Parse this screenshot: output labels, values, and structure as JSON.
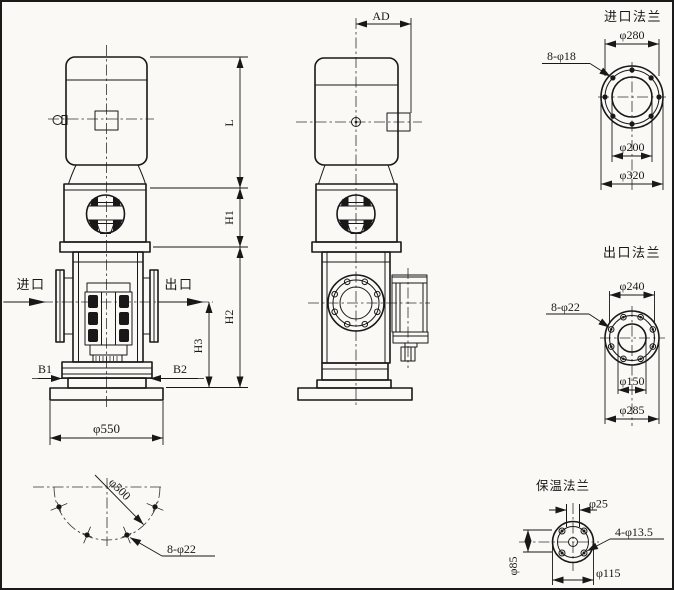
{
  "sheet": {
    "background": "#faf9f6",
    "line_color": "#181818"
  },
  "front_view": {
    "inlet_label": "进口",
    "outlet_label": "出口",
    "b1": "B1",
    "b2": "B2",
    "base_dia": "φ550",
    "dim_l": "L",
    "dim_h1": "H1",
    "dim_h2": "H2",
    "dim_h3": "H3"
  },
  "side_view": {
    "dim_ad": "AD"
  },
  "base_bolt_view": {
    "bolt_circle": "φ500",
    "holes": "8-φ22"
  },
  "inlet_flange": {
    "title": "进口法兰",
    "holes": "8-φ18",
    "bolt_circle": "φ280",
    "bore": "φ200",
    "outer": "φ320"
  },
  "outlet_flange": {
    "title": "出口法兰",
    "holes": "8-φ22",
    "bolt_circle": "φ240",
    "bore": "φ150",
    "outer": "φ285"
  },
  "insulation_flange": {
    "title": "保温法兰",
    "pipe": "φ25",
    "holes": "4-φ13.5",
    "vertical": "φ85",
    "outer": "φ115"
  }
}
